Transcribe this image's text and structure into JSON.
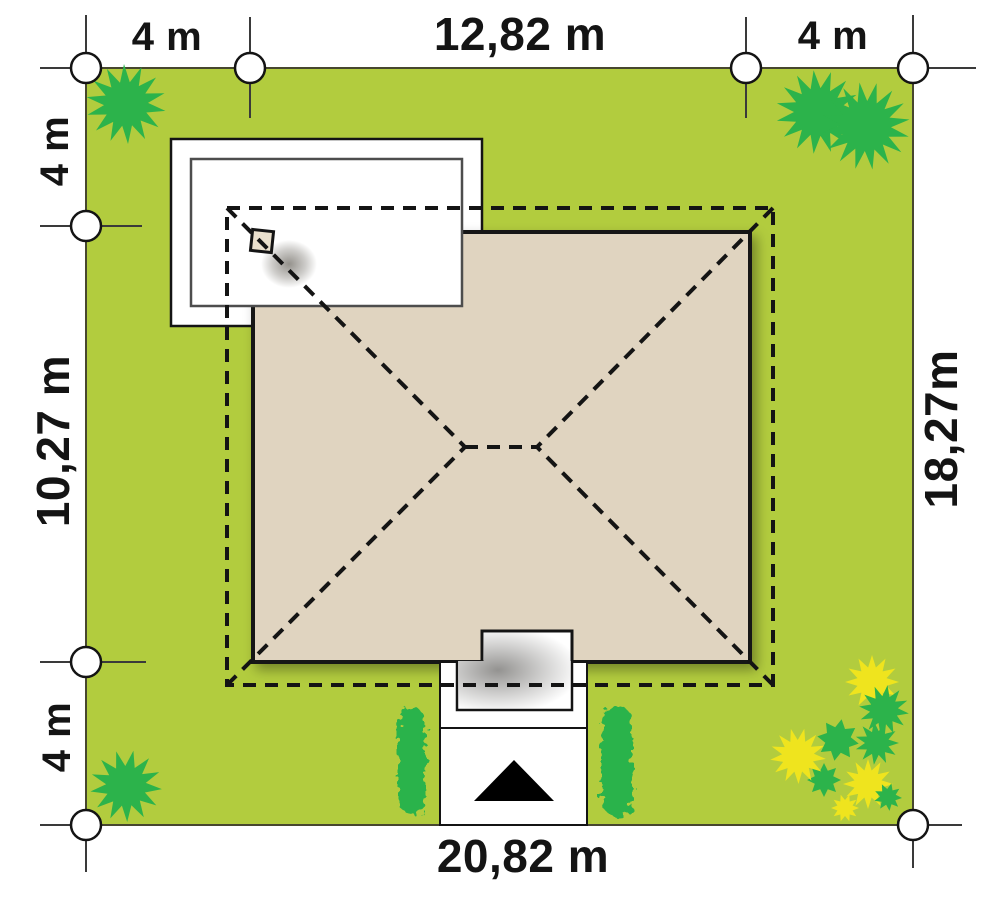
{
  "plan": {
    "dimensions": {
      "top_left_offset": "4 m",
      "top_house_width": "12,82 m",
      "top_right_offset": "4 m",
      "left_top_offset": "4 m",
      "left_house_depth": "10,27 m",
      "left_bottom_offset": "4 m",
      "right_plot_depth": "18,27m",
      "bottom_plot_width": "20,82 m"
    },
    "colors": {
      "lawn": "#b2cc3e",
      "lawn_border": "#47472e",
      "plant_green": "#2cb34b",
      "flower_yellow": "#efe41e",
      "roof": "#e0d4c0",
      "chimney_fill": "#eae0cd",
      "outline": "#141414",
      "terrace_white": "#ffffff"
    }
  }
}
